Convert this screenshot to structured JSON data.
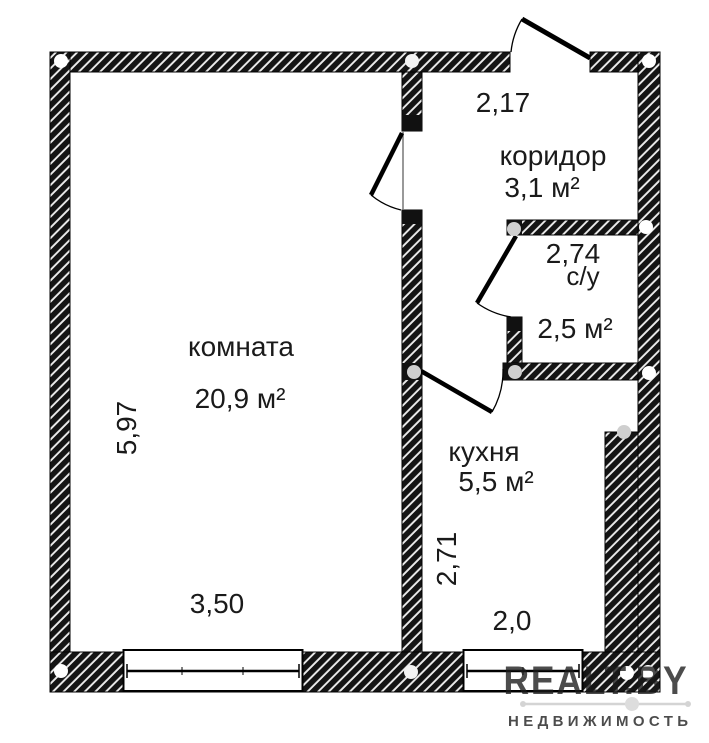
{
  "floorplan": {
    "rooms": [
      {
        "label": "комната",
        "area": "20,9 м²"
      },
      {
        "label": "коридор",
        "area": "3,1 м²"
      },
      {
        "label": "с/у",
        "area": "2,5 м²"
      },
      {
        "label": "кухня",
        "area": "5,5 м²"
      }
    ],
    "dimensions": {
      "room_height_left": "5,97",
      "room_width_bottom": "3,50",
      "corridor_width_top": "2,17",
      "bathroom_width": "2,74",
      "kitchen_height": "2,71",
      "kitchen_width_bottom": "2,0"
    },
    "watermark": {
      "brand": "REALT.BY",
      "tagline": "НЕДВИЖИМОСТЬ"
    },
    "colors": {
      "wall_fill": "#141414",
      "hatch_line": "#ededed",
      "label_text": "#1a1a1a",
      "watermark_gray": "#c9c9c9"
    }
  }
}
